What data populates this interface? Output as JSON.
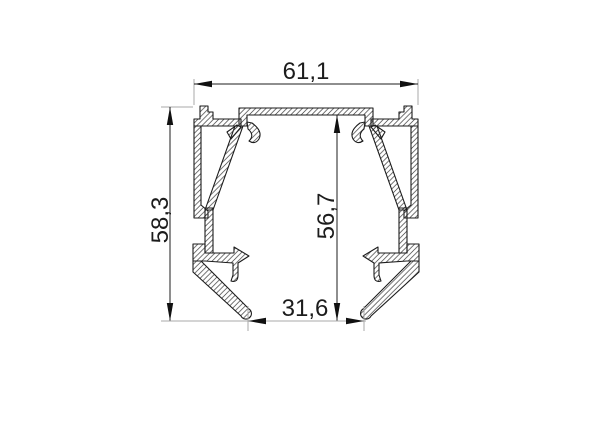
{
  "dimensions": {
    "top_width": {
      "label": "61,1",
      "value": 61.1
    },
    "overall_height": {
      "label": "58,3",
      "value": 58.3
    },
    "inner_height": {
      "label": "56,7",
      "value": 56.7
    },
    "bottom_opening_width": {
      "label": "31,6",
      "value": 31.6
    }
  },
  "colors": {
    "background": "#ffffff",
    "profile_outline": "#1c1c1c",
    "hatch_line": "#3f3f3f",
    "dimension_line": "#1c1c1c",
    "extension_line": "#a8a8a8",
    "text": "#1c1c1c"
  }
}
